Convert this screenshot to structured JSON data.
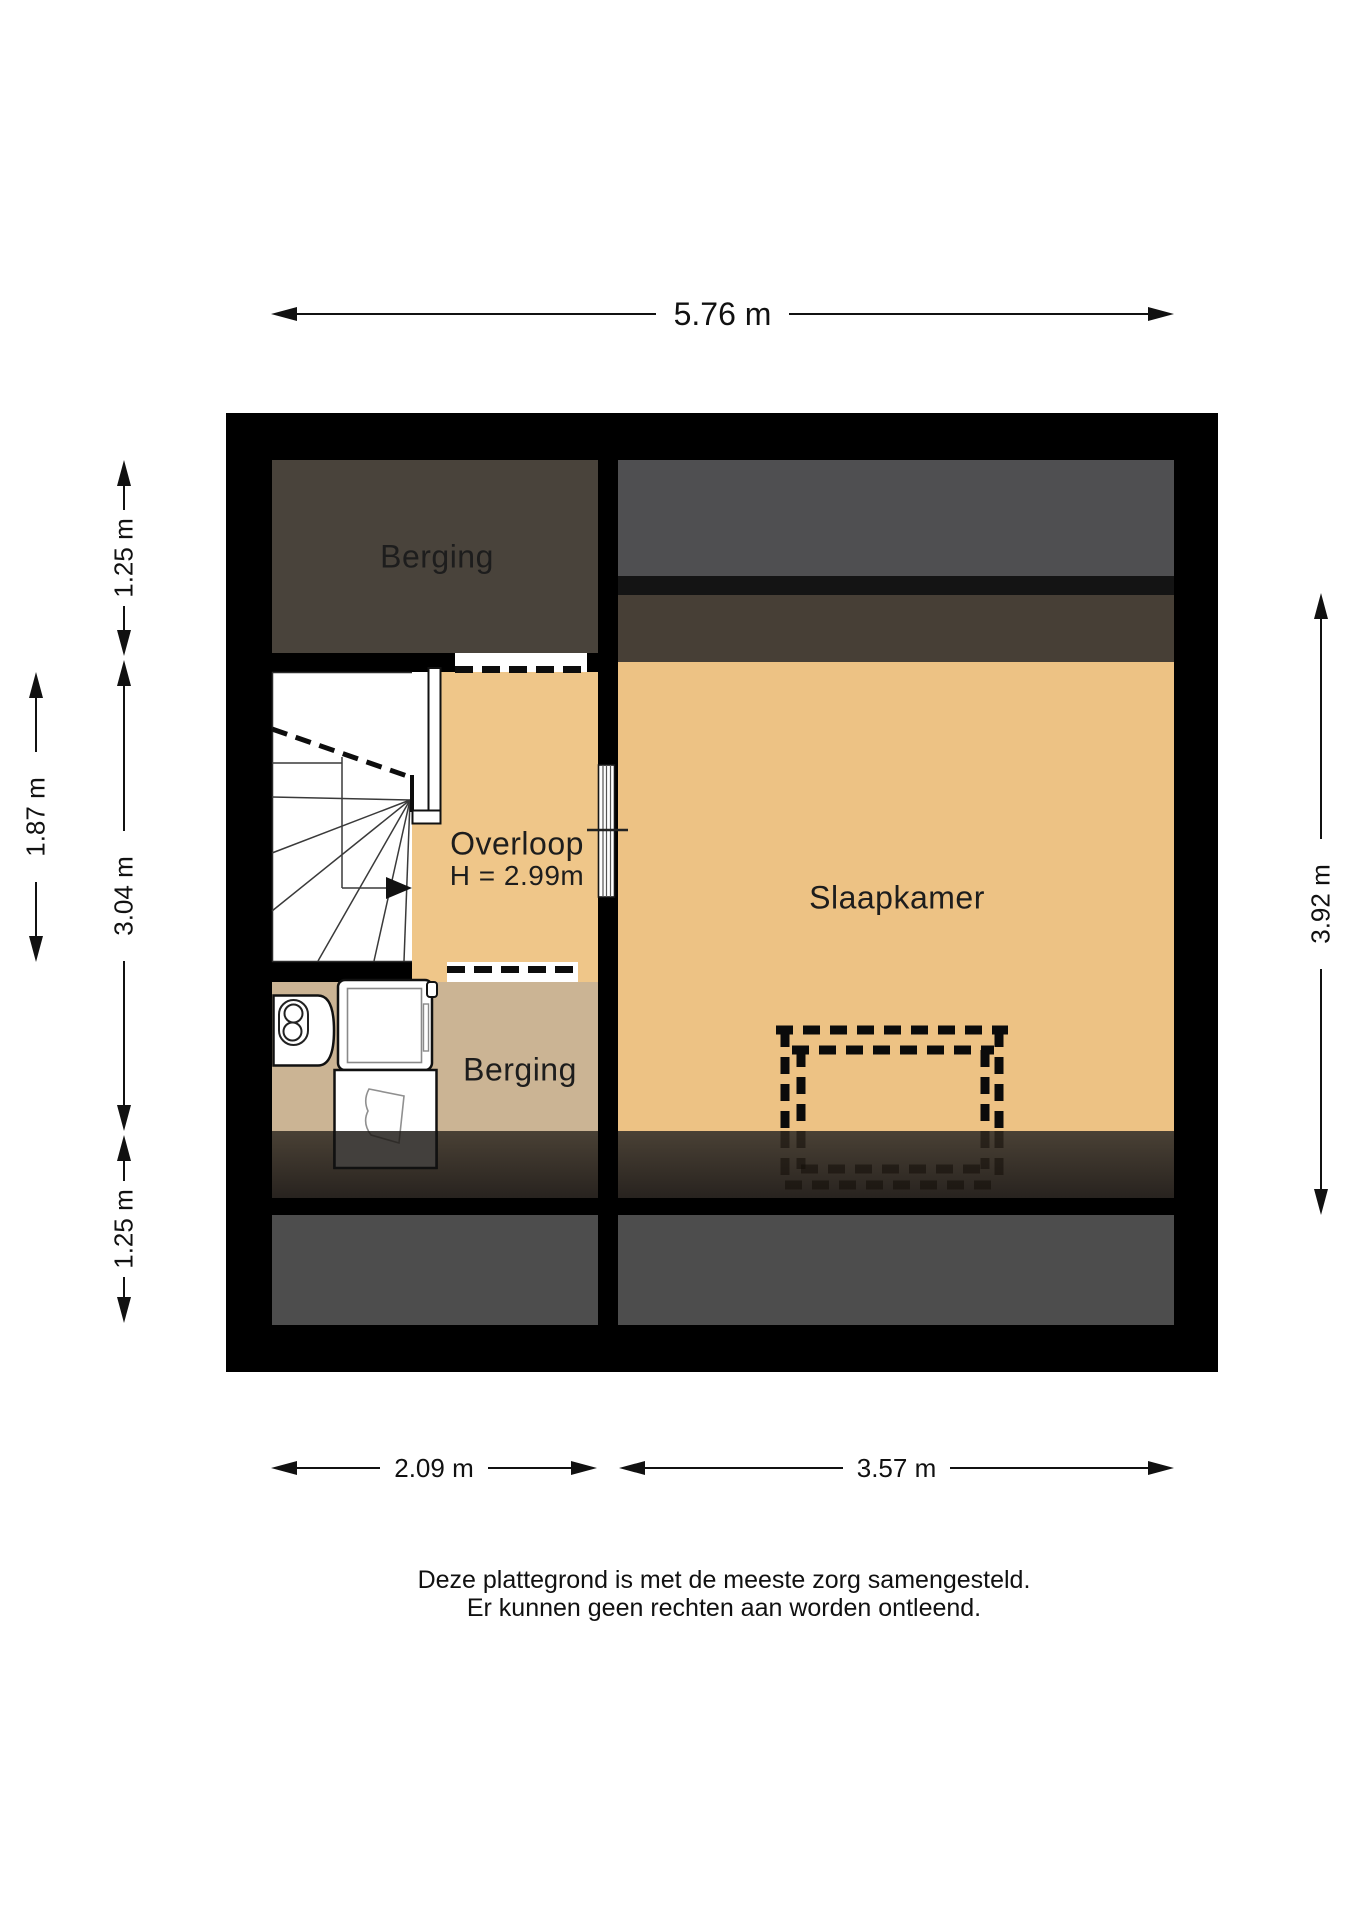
{
  "floorplan": {
    "rooms": {
      "berging_top": {
        "label": "Berging"
      },
      "overloop": {
        "label": "Overloop",
        "ceiling_height": "H = 2.99m"
      },
      "slaapkamer": {
        "label": "Slaapkamer"
      },
      "berging_bottom": {
        "label": "Berging"
      }
    },
    "dimensions": {
      "total_width": "5.76 m",
      "bottom_left_width": "2.09 m",
      "bottom_right_width": "3.57 m",
      "left_top": "1.25 m",
      "left_middle": "3.04 m",
      "left_bottom": "1.25 m",
      "stairwell_height": "1.87 m",
      "right_height": "3.92 m"
    },
    "colors": {
      "wall": "#000000",
      "floor_main": "#edc284",
      "floor_storage": "#cbb494",
      "storage_dark": "#49433b",
      "attic_gray": "#4f4f51",
      "roof_strip_brown": "#473f36",
      "bottom_band_gray": "#4d4d4d"
    }
  },
  "footer": {
    "line1": "Deze plattegrond is met de meeste zorg samengesteld.",
    "line2": "Er kunnen geen rechten aan worden ontleend."
  }
}
